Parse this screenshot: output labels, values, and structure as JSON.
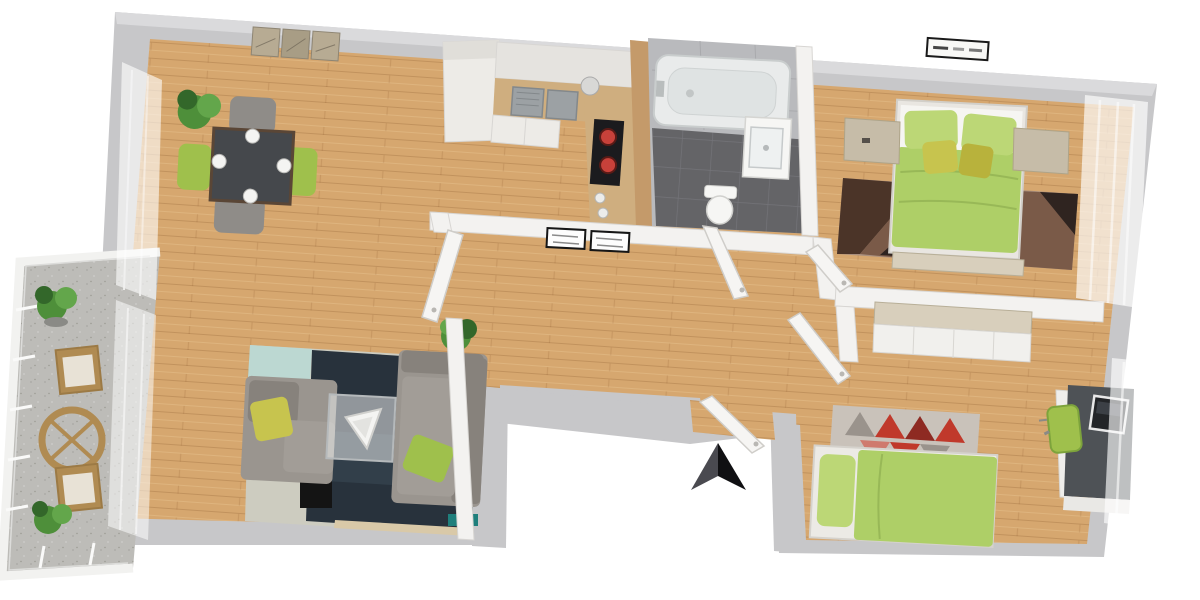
{
  "scene": {
    "type": "3d-floor-plan-render",
    "description": "Isometric 3D rendered floor plan of a two-bedroom apartment with balcony, viewed from above at a slight tilt",
    "compass": {
      "points": "up",
      "style": "two-tone dark arrowhead"
    },
    "rooms": [
      {
        "name": "living-dining-room",
        "floor": "wood",
        "furniture": [
          "dining-table-with-4-plates",
          "2-green-chairs",
          "2-gray-chairs",
          "potted-plant",
          "wall-art-triptych",
          "gray-armchair",
          "gray-sofa",
          "glass-coffee-table",
          "navy-area-rug",
          "tv-cabinet"
        ]
      },
      {
        "name": "kitchen",
        "floor": "wood",
        "furniture": [
          "tall-cabinet",
          "counter-with-double-sink",
          "cooktop-with-red-burners",
          "wood-side-panel"
        ]
      },
      {
        "name": "bathroom",
        "floor": "dark-gray-tile",
        "furniture": [
          "bathtub",
          "washbasin-cabinet",
          "toilet"
        ]
      },
      {
        "name": "hallway",
        "floor": "wood",
        "furniture": [
          "two-framed-wall-panels",
          "open-doors"
        ]
      },
      {
        "name": "main-bedroom",
        "floor": "wood",
        "furniture": [
          "double-bed-green-duvet",
          "2-nightstands",
          "brown-geometric-rug",
          "foot-bench",
          "wall-vent-panel",
          "sheer-curtains"
        ]
      },
      {
        "name": "second-bedroom",
        "floor": "wood",
        "furniture": [
          "single-bed-green-duvet",
          "triangle-pattern-rug",
          "white-wardrobe",
          "desk-with-laptop",
          "green-desk-chair",
          "sheer-curtains"
        ]
      },
      {
        "name": "balcony",
        "floor": "speckled-concrete",
        "furniture": [
          "round-wood-table",
          "2-wood-chairs",
          "2-potted-plants",
          "white-glass-railing"
        ]
      }
    ]
  },
  "palette": {
    "page": "#ffffff",
    "shell": "#c7c7c9",
    "shellLight": "#dadadc",
    "wallWhite": "#f3f2f0",
    "wallEdge": "#d8d6d3",
    "wood": "#d6a76f",
    "woodDark": "#c49a6a",
    "counterWood": "#cfae7f",
    "cabinet": "#edebe7",
    "cabinetShade": "#e0ded9",
    "steel": "#9ca1a4",
    "steelDark": "#83888b",
    "cooktop": "#1b1b1e",
    "burner": "#c8413a",
    "bathWall": "#b9babd",
    "bathFloor": "#646467",
    "grout": "#747479",
    "tub": "#e9ebeb",
    "tubInner": "#dfe3e3",
    "fixWhite": "#f6f6f4",
    "duvet": "#aecf67",
    "pillow": "#bcd776",
    "cushion": "#c7c44e",
    "accentGreen": "#9fc04c",
    "sofa": "#9a958f",
    "sofaDark": "#87827c",
    "rugNavy": "#28323c",
    "rugNavyLight": "#3a4a55",
    "rugTeal": "#1f7f7c",
    "rugPale": "#cdccc0",
    "rugMint": "#bcd8d2",
    "tableDark": "#45484c",
    "chairGray": "#8f8c88",
    "plantGreen": "#4e8f3a",
    "plantDark": "#33672a",
    "plantLight": "#63a64b",
    "travertine": "#c6bca8",
    "travertineLight": "#d8cfbc",
    "rugBrown1": "#4b3428",
    "rugBrown2": "#7a5a48",
    "rugBrown3": "#a98f7e",
    "rugBrownDark": "#2f2420",
    "rug2base": "#c9c2ba",
    "rug2red": "#c0392b",
    "rug2dark": "#8e2a22",
    "rug2pink": "#cf7a6e",
    "rug2teal": "#1f8a8a",
    "rug2black": "#1d1d1f",
    "rug2gray": "#9a938c",
    "deskDark": "#4e5256",
    "laptop": "#232528",
    "balconyFloor": "#bdbcb8",
    "balconyWood": "#b08b52",
    "balconyWoodDark": "#9c7a45",
    "arrowLeft": "#4a4a50",
    "arrowRight": "#101012",
    "blackItem": "#141414",
    "artTone": "#b7ab93"
  }
}
